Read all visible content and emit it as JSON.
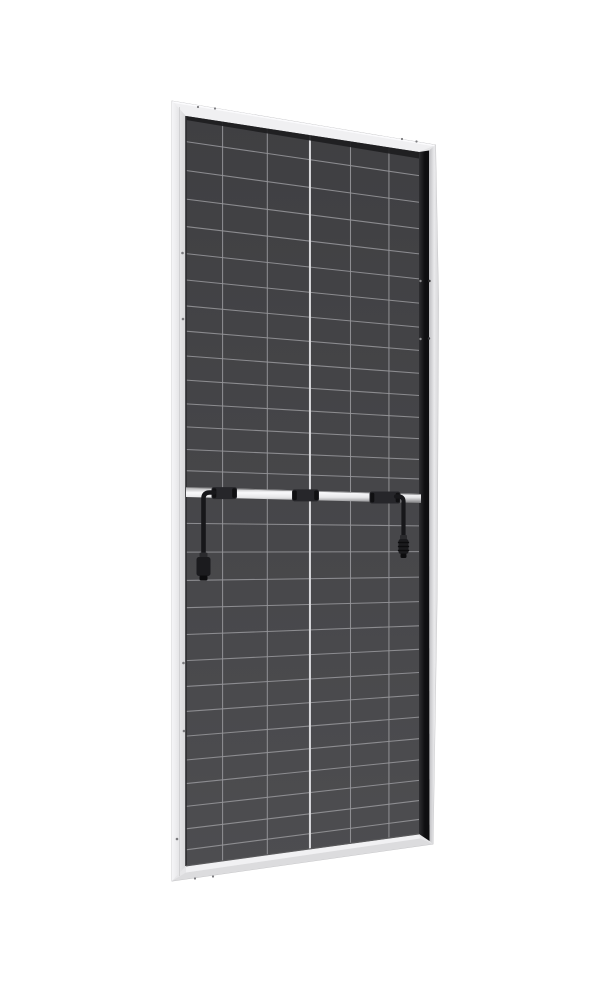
{
  "canvas": {
    "width": 600,
    "height": 1000,
    "background": "#ffffff"
  },
  "subject": "rear-view-framed-solar-panel-with-junction-boxes-and-mc4-cables",
  "colors": {
    "background": "#ffffff",
    "frame_base": "#e6e6e8",
    "frame_outline": "#c2c2c4",
    "frame_top": "#f0f0f2",
    "frame_top_highlight": "#fbfbfd",
    "frame_left_outer": "#f5f5f7",
    "frame_left_inner": "#d7d7d9",
    "frame_left_ridge": "#c9c9cb",
    "frame_bottom_face": "#dcdcde",
    "frame_bottom_lip": "#f1f1f3",
    "frame_right_lip_inner": "#bdbdc0",
    "frame_right_lip_outer": "#eaeaec",
    "cell_top": "#3f3f42",
    "cell_bottom": "#4d4d50",
    "grid_line": "#96969a",
    "center_line": "#d9d9dc",
    "left_seam": "#2b2b2d",
    "bottom_seam": "#5a5a5c",
    "top_shadow": "#1d1d1f",
    "band_dark": "#0e0e10",
    "band_light": "#2e2e31",
    "rail_top": "#a8a8aa",
    "rail_bright": "#f9f9fb",
    "rail_mid": "#e6e6e8",
    "rail_bottom": "#7d7d7f",
    "rail_edge": "#6f6f71",
    "box_fill": "#26262a",
    "box_nub": "#101012",
    "cable": "#17171a",
    "connector_body": "#1b1b1e",
    "connector_collar": "#2a2a2d",
    "connector_dark": "#0c0c0e",
    "hole_on_frame": "#7b7b7e",
    "hole_on_band": "#8e8e90",
    "hole_on_lip": "#3a3a3c"
  },
  "geometry": {
    "outer": [
      [
        172,
        101
      ],
      [
        435.5,
        145
      ],
      [
        438.5,
        300
      ],
      [
        437,
        600
      ],
      [
        433,
        844
      ],
      [
        172,
        881
      ]
    ],
    "inner": {
      "tl": [
        186,
        116
      ],
      "tr": [
        419,
        152
      ],
      "br": [
        419,
        834
      ],
      "bl": [
        186,
        866
      ]
    },
    "top_strip": [
      [
        172,
        101
      ],
      [
        435.5,
        145
      ],
      [
        419,
        152
      ],
      [
        186,
        116
      ]
    ],
    "left_strip": [
      [
        172,
        101
      ],
      [
        186,
        116
      ],
      [
        186,
        866
      ],
      [
        172,
        881
      ]
    ],
    "left_ridge": {
      "x": 179.5,
      "y0": 107,
      "y1": 876
    },
    "bottom_face": [
      [
        186,
        872.5
      ],
      [
        420,
        838.5
      ],
      [
        433,
        844
      ],
      [
        172,
        881
      ]
    ],
    "bottom_lip": [
      [
        186,
        866.5
      ],
      [
        419,
        834.5
      ],
      [
        420,
        838.5
      ],
      [
        186,
        872.5
      ]
    ],
    "right_lip": [
      [
        429,
        150.5
      ],
      [
        435.5,
        145
      ],
      [
        438.5,
        300
      ],
      [
        437,
        600
      ],
      [
        433,
        844
      ],
      [
        429.5,
        841
      ]
    ],
    "dark_band": [
      [
        419,
        152
      ],
      [
        429,
        150.5
      ],
      [
        429.5,
        841
      ],
      [
        419,
        834
      ]
    ],
    "top_shadow": [
      [
        186,
        116
      ],
      [
        419,
        152
      ],
      [
        419,
        158.5
      ],
      [
        186,
        120
      ]
    ]
  },
  "grid": {
    "left_x": 186,
    "right_x": 419,
    "col_fractions": [
      0.157,
      0.349,
      0.532,
      0.706,
      0.871
    ],
    "center_col_index": 2,
    "row_fractions": [
      0.069,
      0.147,
      0.224,
      0.298,
      0.371,
      0.442,
      0.512,
      0.58,
      0.647,
      0.712,
      0.776,
      0.838,
      0.899,
      0.956
    ],
    "halves": [
      {
        "left_y": [
          116,
          487
        ],
        "right_y": [
          152,
          494
        ]
      },
      {
        "left_y": [
          498,
          866
        ],
        "right_y": [
          503,
          834
        ]
      }
    ]
  },
  "rail": {
    "x0": 186,
    "x1": 421,
    "y0_center": 492,
    "y1_center": 498.5,
    "half_h0": 5,
    "half_h1": 4.5
  },
  "junction_boxes": [
    {
      "x": 211.5,
      "w": 25.5
    },
    {
      "x": 292,
      "w": 27
    },
    {
      "x": 369.5,
      "w": 31
    }
  ],
  "cables": {
    "left": {
      "exit_x": 214,
      "drop_x": 203.5,
      "exit_y": 492.5,
      "bend_r": 6,
      "end_y": 555,
      "width": 4.6,
      "connector": {
        "cx": 203.5,
        "collar_y": 552.5,
        "collar_w": 8,
        "collar_h": 5,
        "body_y": 557,
        "body_w": 14,
        "body_h": 19,
        "tip_y": 575.5,
        "tip_w": 8,
        "tip_h": 5,
        "ribs": []
      }
    },
    "right": {
      "exit_x": 396,
      "drop_x": 403.5,
      "exit_y": 496.5,
      "bend_r": 5,
      "end_y": 537,
      "width": 4.2,
      "connector": {
        "cx": 403.5,
        "collar_y": 535,
        "collar_w": 7,
        "collar_h": 4.5,
        "body_y": 539,
        "body_w": 10,
        "body_h": 15,
        "tip_y": 553.5,
        "tip_w": 6,
        "tip_h": 4.5,
        "ribs": [
          542.5,
          546.5,
          550.5
        ]
      }
    }
  },
  "holes": {
    "left_frame": [
      [
        182.5,
        253
      ],
      [
        183,
        319
      ],
      [
        183.5,
        663
      ],
      [
        184,
        731
      ],
      [
        177,
        839
      ]
    ],
    "top_frame": [
      [
        198,
        107
      ],
      [
        215,
        108.5
      ],
      [
        402,
        139
      ],
      [
        416.5,
        141.5
      ]
    ],
    "bottom_frame": [
      [
        195,
        878.5
      ],
      [
        213,
        876.5
      ]
    ],
    "right_band": [
      [
        420.5,
        281
      ],
      [
        420.5,
        339
      ]
    ],
    "right_lip": [
      [
        429.5,
        281
      ],
      [
        429,
        338.5
      ]
    ]
  }
}
